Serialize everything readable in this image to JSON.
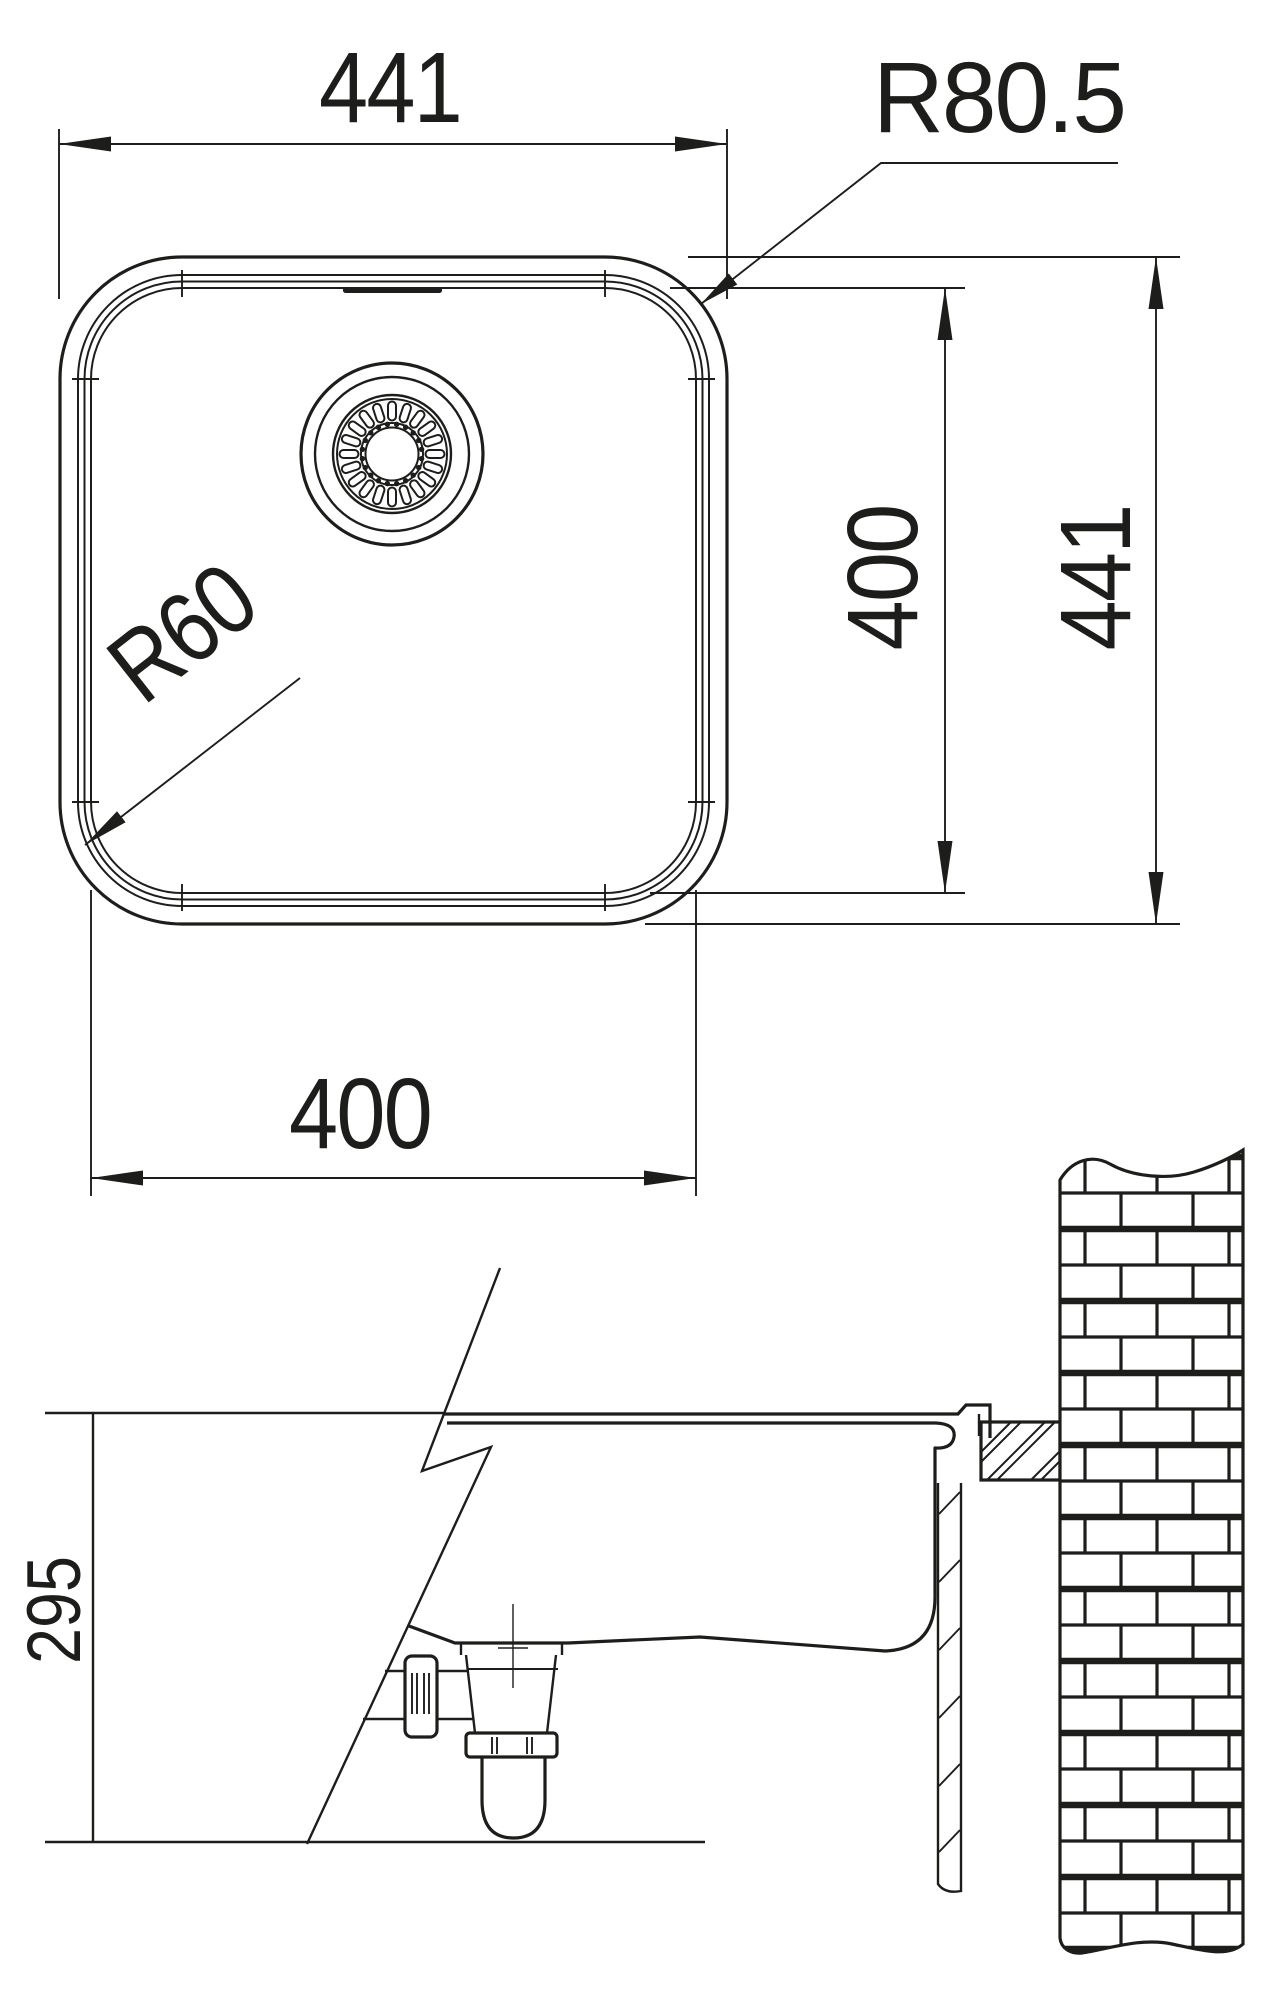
{
  "meta": {
    "type": "technical-dimension-drawing",
    "subject": "Square undermount kitchen sink - top view and broken section view with waste trap, countertop and brick wall"
  },
  "colors": {
    "ink": "#1d1d1b",
    "paper": "#ffffff"
  },
  "labels": {
    "top_width": "441",
    "outer_corner_radius": "R80.5",
    "bowl_corner_radius": "R60",
    "inner_height": "400",
    "outer_height": "441",
    "inner_width": "400",
    "section_depth": "295"
  }
}
